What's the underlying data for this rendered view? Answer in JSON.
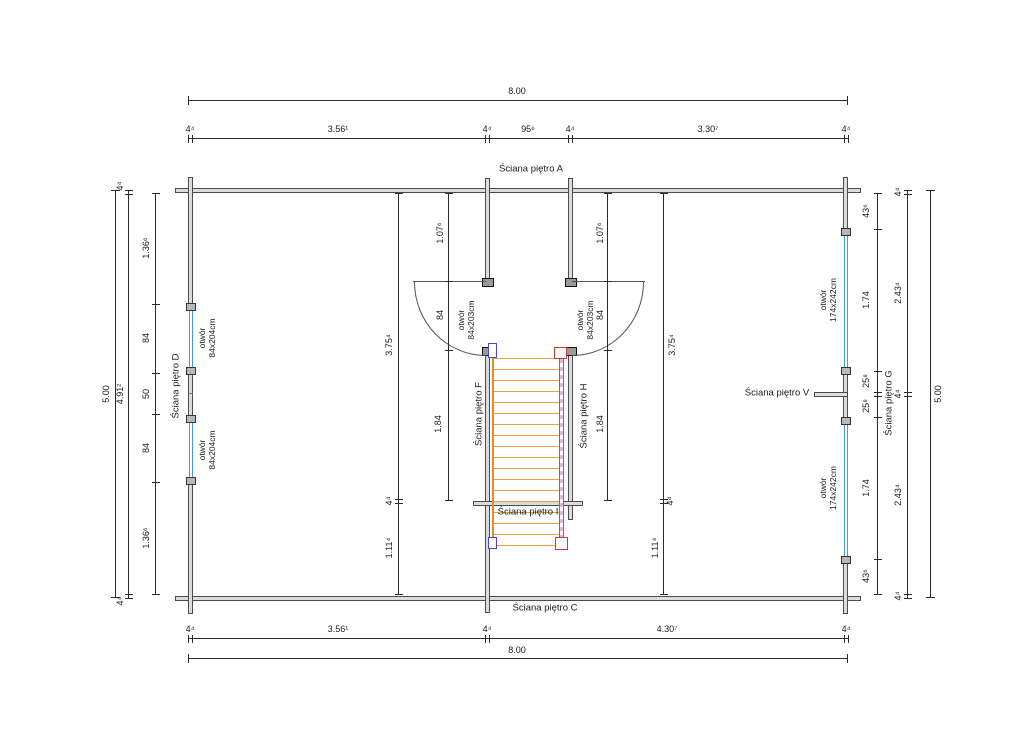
{
  "drawing": {
    "walls": {
      "a": "Ściana piętro A",
      "c": "Ściana piętro C",
      "d": "Ściana piętro D",
      "f": "Ściana piętro F",
      "g": "Ściana piętro G",
      "h": "Ściana piętro H",
      "i": "Ściana piętro I",
      "v": "Ściana piętro V"
    },
    "openings": {
      "label": "otwór",
      "left_size": "84x204cm",
      "center_size": "84x203cm",
      "right_size": "174x242cm"
    },
    "dims": {
      "top": {
        "overall": "8.00",
        "chain": [
          "4⁴",
          "3.56¹",
          "4⁴",
          "95⁶",
          "4⁴",
          "3.30⁷",
          "4⁴"
        ]
      },
      "bottom": {
        "overall": "8.00",
        "chain": [
          "4⁴",
          "3.56¹",
          "4⁴",
          "4.30⁷",
          "4⁴"
        ]
      },
      "left": {
        "overall": "5.00",
        "mid": [
          "4⁴",
          "4.91²",
          "4⁴"
        ],
        "inner": [
          "1.36⁶",
          "84",
          "50",
          "84",
          "1.36⁶"
        ]
      },
      "right": {
        "overall": "5.00",
        "mid": [
          "4⁴",
          "2.43⁴",
          "4⁴",
          "2.43⁴",
          "4⁴"
        ],
        "inner": [
          "43⁶",
          "1.74",
          "25⁸",
          "25⁸",
          "1.74",
          "43⁶"
        ]
      },
      "stair": {
        "outer": [
          "3.75⁴",
          "4⁴",
          "1.11⁴"
        ],
        "inner": [
          "1.07⁶",
          "84",
          "1.84"
        ]
      }
    },
    "colors": {
      "opening_blue": "#3f9bf0",
      "tread_orange": "#e2a33c",
      "stringer_left": "#d98f2b",
      "stringer_right": "#c2479c",
      "cap_red": "#cf3636",
      "cap_blue": "#4545d8",
      "wall_fill": "#dcdcdc"
    }
  }
}
